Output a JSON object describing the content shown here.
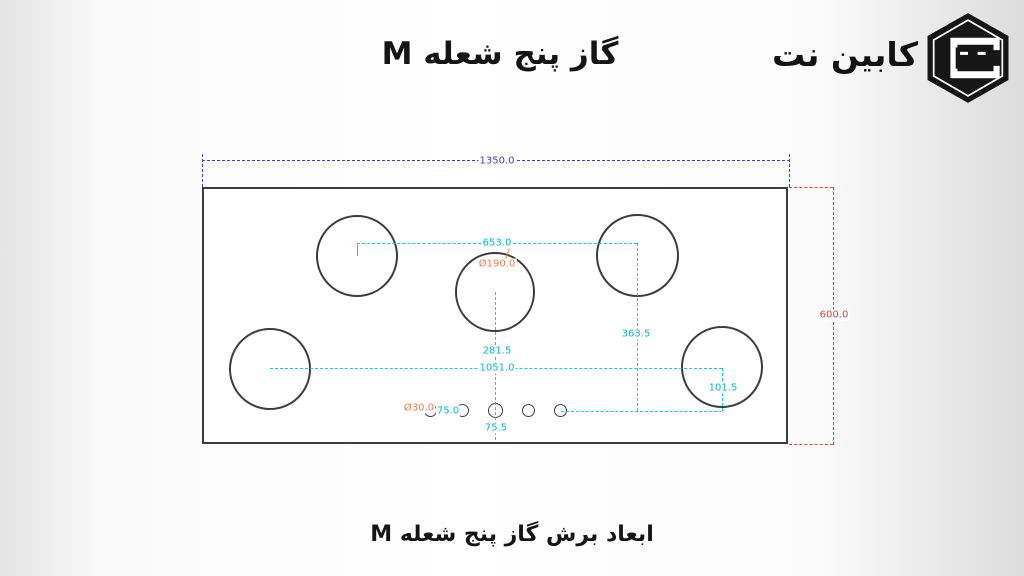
{
  "page": {
    "title": "گاز پنج شعله M",
    "caption": "ابعاد برش گاز پنج شعله M"
  },
  "logo": {
    "brand_name": "کابین نت",
    "mark": "hexagon-cabinet-icon"
  },
  "colors": {
    "overall_width_dim": "#3d3dc8",
    "overall_height_dim": "#e03a3a",
    "internal_dims": "#00d4d4",
    "diameter_dims": "#ef8046",
    "outline": "#3c3c3c"
  },
  "diagram": {
    "overall_width_label": "1350.0",
    "overall_height_label": "600.0",
    "dims": {
      "top_burner_spacing": "653.0",
      "right_vertical_offset": "363.5",
      "center_vertical_offset": "281.5",
      "bottom_burner_spacing": "1051.0",
      "knob_row_offset": "101.5",
      "knob_spacing": "75.0",
      "knob_bottom_offset": "75.5",
      "burner_diameter": "Ø190.0",
      "knob_diameter": "Ø30.0"
    },
    "counts": {
      "burners": 5,
      "knobs": 5
    }
  }
}
